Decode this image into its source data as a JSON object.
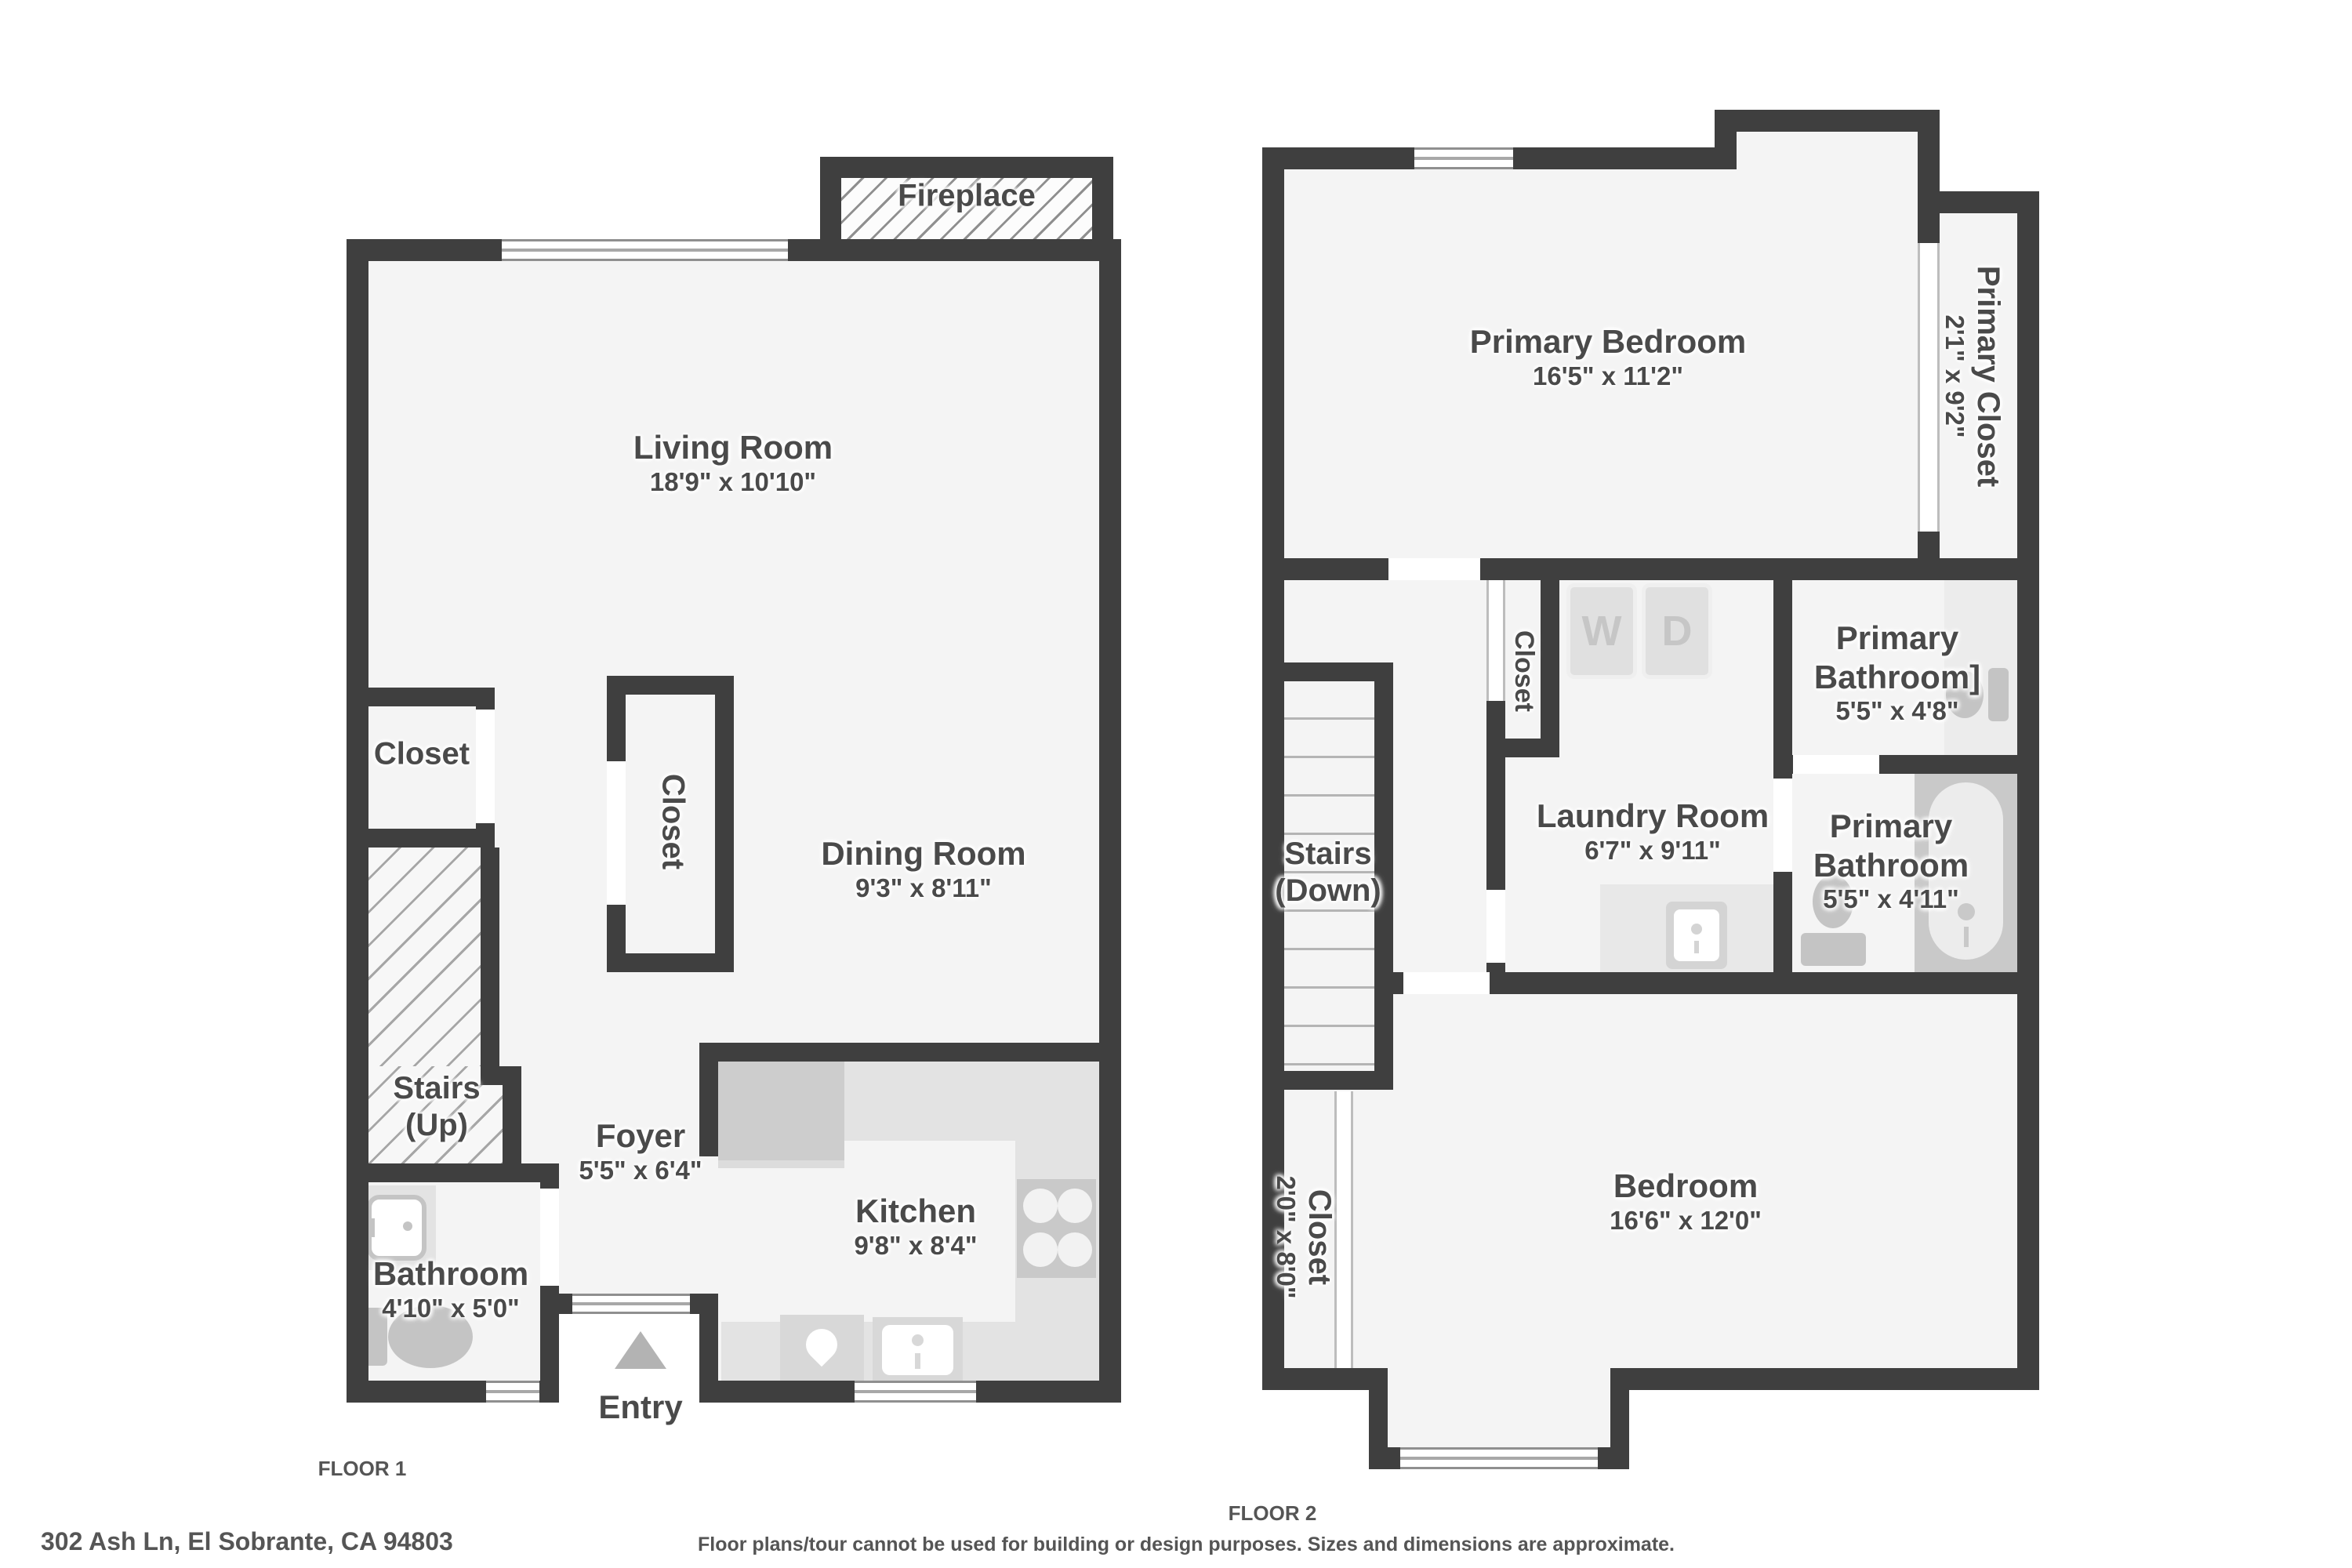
{
  "footer": {
    "address": "302 Ash Ln, El Sobrante, CA 94803",
    "disclaimer": "Floor plans/tour cannot be used for building or design purposes. Sizes and dimensions are approximate."
  },
  "colors": {
    "wall": "#3f3f3f",
    "floor": "#f4f4f4",
    "text": "#4a4a4a",
    "counter": "#e3e3e3",
    "appliance": "#cdcdcd",
    "fixture": "#c6c6c6",
    "util": "#e8e8e8"
  },
  "floor1": {
    "caption": "FLOOR 1",
    "living": {
      "label": "Living Room",
      "dims": "18'9\" x 10'10\""
    },
    "dining": {
      "label": "Dining Room",
      "dims": "9'3\" x 8'11\""
    },
    "kitchen": {
      "label": "Kitchen",
      "dims": "9'8\" x 8'4\""
    },
    "foyer": {
      "label": "Foyer",
      "dims": "5'5\" x 6'4\""
    },
    "bathroom": {
      "label": "Bathroom",
      "dims": "4'10\" x 5'0\""
    },
    "closet_left": {
      "label": "Closet"
    },
    "closet_mid": {
      "label": "Closet"
    },
    "stairs": {
      "line1": "Stairs",
      "line2": "(Up)"
    },
    "fireplace": {
      "label": "Fireplace"
    },
    "entry": {
      "label": "Entry"
    }
  },
  "floor2": {
    "caption": "FLOOR 2",
    "primary_bedroom": {
      "label": "Primary Bedroom",
      "dims": "16'5\" x 11'2\""
    },
    "primary_closet": {
      "label": "Primary Closet",
      "dims": "2'1\" x 9'2\""
    },
    "closet_small": {
      "label": "Closet"
    },
    "laundry": {
      "label": "Laundry Room",
      "dims": "6'7\" x 9'11\""
    },
    "bath_upper": {
      "line1": "Primary",
      "line2": "Bathroom]",
      "dims": "5'5\" x 4'8\""
    },
    "bath_lower": {
      "line1": "Primary",
      "line2": "Bathroom",
      "dims": "5'5\" x 4'11\""
    },
    "stairs": {
      "line1": "Stairs",
      "line2": "(Down)"
    },
    "bedroom": {
      "label": "Bedroom",
      "dims": "16'6\" x 12'0\""
    },
    "closet_bottom": {
      "label": "Closet",
      "dims": "2'0\" x 8'0\""
    },
    "washer_label": "W",
    "dryer_label": "D"
  }
}
